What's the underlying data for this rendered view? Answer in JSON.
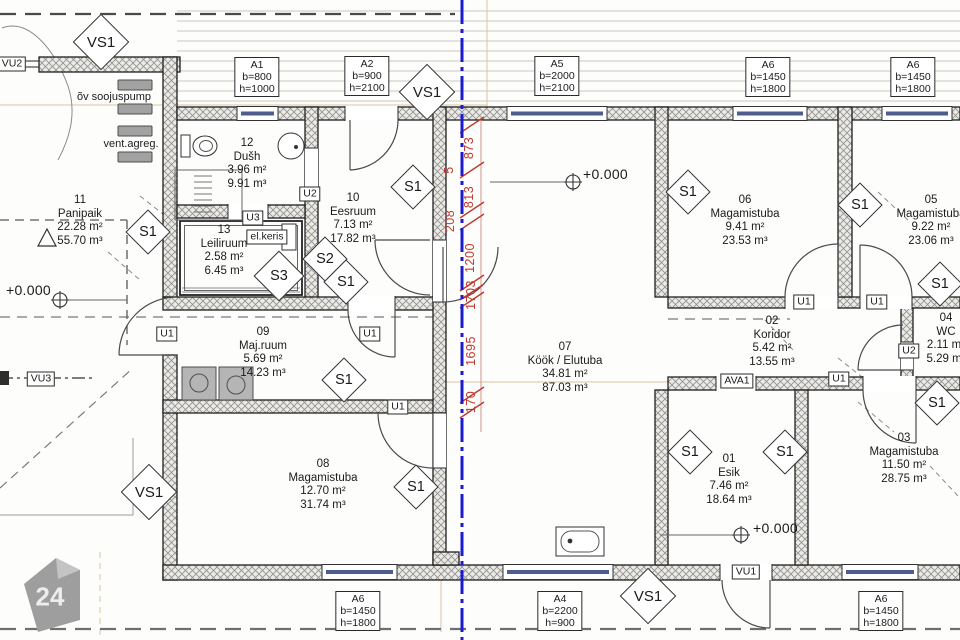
{
  "colors": {
    "centerline": "#1a1ad0",
    "dimension": "#c0392b"
  },
  "logo": {
    "text": "24"
  },
  "elevation_label": "+0.000",
  "markers": {
    "s1": "S1",
    "s2": "S2",
    "s3": "S3",
    "vs1": "VS1"
  },
  "equipment": {
    "heat_pump": "õv soojuspump",
    "vent_unit": "vent.agreg.",
    "sauna_heater": "el.keris"
  },
  "dimensions": {
    "values": [
      "873",
      "5",
      "813",
      "208",
      "1200",
      "1703",
      "1695",
      "170"
    ]
  },
  "rooms": [
    {
      "number": "12",
      "name": "Dušh",
      "area": "3.96 m²",
      "volume": "9.91 m³"
    },
    {
      "number": "13",
      "name": "Leiliruum",
      "area": "2.58 m²",
      "volume": "6.45 m³"
    },
    {
      "number": "10",
      "name": "Eesruum",
      "area": "7.13 m²",
      "volume": "17.82 m³"
    },
    {
      "number": "11",
      "name": "Panipaik",
      "area": "22.28 m²",
      "volume": "55.70 m³"
    },
    {
      "number": "09",
      "name": "Maj.ruum",
      "area": "5.69 m²",
      "volume": "14.23 m³"
    },
    {
      "number": "08",
      "name": "Magamistuba",
      "area": "12.70 m²",
      "volume": "31.74 m³"
    },
    {
      "number": "07",
      "name": "Köök / Elutuba",
      "area": "34.81 m²",
      "volume": "87.03 m³"
    },
    {
      "number": "06",
      "name": "Magamistuba",
      "area": "9.41 m²",
      "volume": "23.53 m³"
    },
    {
      "number": "05",
      "name": "Magamistuba",
      "area": "9.22 m²",
      "volume": "23.06 m³"
    },
    {
      "number": "02",
      "name": "Koridor",
      "area": "5.42 m²",
      "volume": "13.55 m³"
    },
    {
      "number": "01",
      "name": "Esik",
      "area": "7.46 m²",
      "volume": "18.64 m³"
    },
    {
      "number": "03",
      "name": "Magamistuba",
      "area": "11.50 m²",
      "volume": "28.75 m³"
    },
    {
      "number": "04",
      "name": "WC",
      "area": "2.11 m²",
      "volume": "5.29 m³"
    }
  ],
  "windows": [
    {
      "label": "A1",
      "b": "b=800",
      "h": "h=1000"
    },
    {
      "label": "A2",
      "b": "b=900",
      "h": "h=2100"
    },
    {
      "label": "A5",
      "b": "b=2000",
      "h": "h=2100"
    },
    {
      "label": "A6",
      "b": "b=1450",
      "h": "h=1800"
    },
    {
      "label": "A6",
      "b": "b=1450",
      "h": "h=1800"
    },
    {
      "label": "A6",
      "b": "b=1450",
      "h": "h=1800"
    },
    {
      "label": "A4",
      "b": "b=2200",
      "h": "h=900"
    },
    {
      "label": "A6",
      "b": "b=1450",
      "h": "h=1800"
    }
  ],
  "door_tags": [
    {
      "label": "VU2"
    },
    {
      "label": "U2"
    },
    {
      "label": "U3"
    },
    {
      "label": "U1"
    },
    {
      "label": "U1"
    },
    {
      "label": "U1"
    },
    {
      "label": "VU3"
    },
    {
      "label": "AVA1"
    },
    {
      "label": "U1"
    },
    {
      "label": "U1"
    },
    {
      "label": "U2"
    },
    {
      "label": "U1"
    },
    {
      "label": "VU1"
    }
  ]
}
